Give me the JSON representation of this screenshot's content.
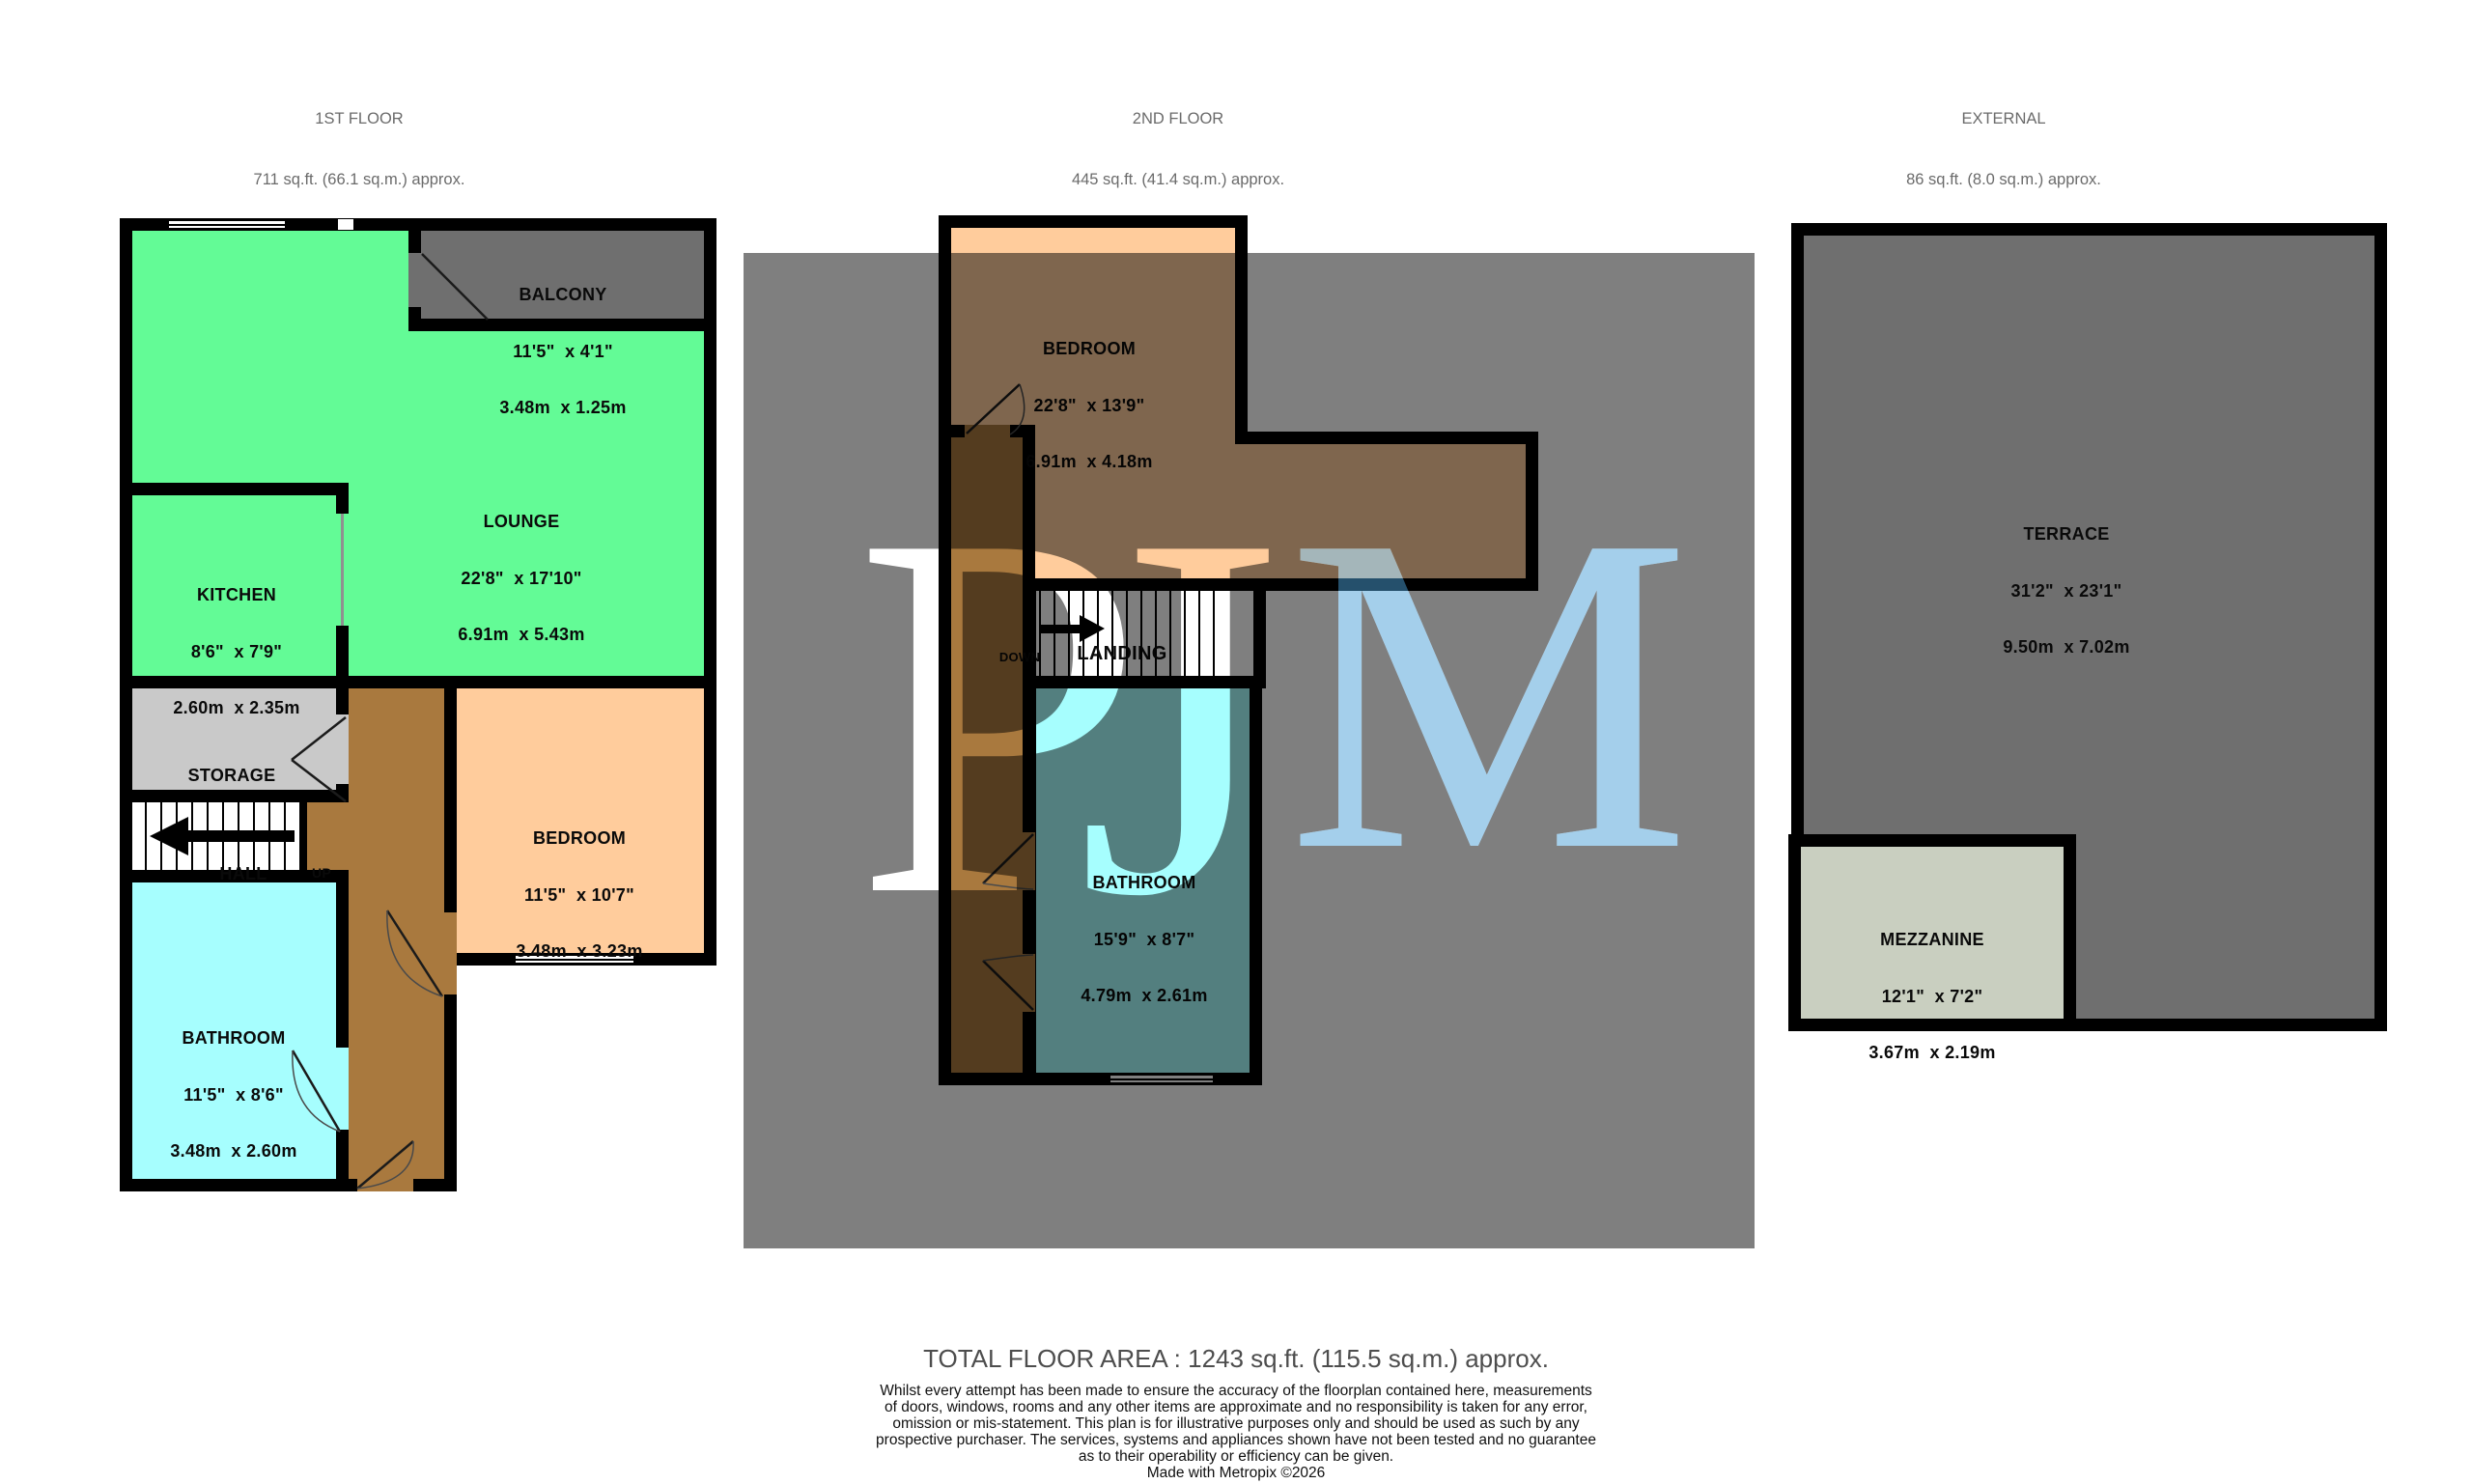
{
  "headers": [
    {
      "title": "1ST FLOOR",
      "area": "711 sq.ft. (66.1 sq.m.) approx."
    },
    {
      "title": "2ND FLOOR",
      "area": "445 sq.ft. (41.4 sq.m.) approx."
    },
    {
      "title": "EXTERNAL",
      "area": "86 sq.ft. (8.0 sq.m.) approx."
    }
  ],
  "rooms": {
    "balcony": {
      "name": "BALCONY",
      "imperial": "11'5\"  x 4'1\"",
      "metric": "3.48m  x 1.25m"
    },
    "lounge": {
      "name": "LOUNGE",
      "imperial": "22'8\"  x 17'10\"",
      "metric": "6.91m  x 5.43m"
    },
    "kitchen": {
      "name": "KITCHEN",
      "imperial": "8'6\"  x 7'9\"",
      "metric": "2.60m  x 2.35m"
    },
    "storage": {
      "name": "STORAGE"
    },
    "hall": {
      "name": "HALL",
      "up": "UP"
    },
    "bedroom1": {
      "name": "BEDROOM",
      "imperial": "11'5\"  x 10'7\"",
      "metric": "3.48m  x 3.23m"
    },
    "bathroom1": {
      "name": "BATHROOM",
      "imperial": "11'5\"  x 8'6\"",
      "metric": "3.48m  x 2.60m"
    },
    "bedroom2": {
      "name": "BEDROOM",
      "imperial": "22'8\"  x 13'9\"",
      "metric": "6.91m  x 4.18m"
    },
    "landing": {
      "name": "LANDING",
      "down": "DOWN"
    },
    "bathroom2": {
      "name": "BATHROOM",
      "imperial": "15'9\"  x 8'7\"",
      "metric": "4.79m  x 2.61m"
    },
    "terrace": {
      "name": "TERRACE",
      "imperial": "31'2\"  x 23'1\"",
      "metric": "9.50m  x 7.02m"
    },
    "mezzanine": {
      "name": "MEZZANINE",
      "imperial": "12'1\"  x 7'2\"",
      "metric": "3.67m  x 2.19m"
    }
  },
  "watermark": {
    "letter_p": "P",
    "letter_j": "J",
    "letter_m": "M"
  },
  "footer": {
    "total": "TOTAL FLOOR AREA : 1243 sq.ft. (115.5 sq.m.) approx.",
    "disclaimer_lines": [
      "Whilst every attempt has been made to ensure the accuracy of the floorplan contained here, measurements",
      "of doors, windows, rooms and any other items are approximate and no responsibility is taken for any error,",
      "omission or mis-statement. This plan is for illustrative purposes only and should be used as such by any",
      "prospective purchaser. The services, systems and appliances shown have not been tested and no guarantee",
      "as to their operability or efficiency can be given."
    ],
    "credit": "Made with Metropix ©2026"
  },
  "colors": {
    "page_bg": "#ffffff",
    "wall": "#000000",
    "green": "#63FB96",
    "peach": "#FFCC9C",
    "cyan": "#A6FEFE",
    "brown": "#A9793E",
    "grey_room": "#C9C9C9",
    "grey_balcony": "#6F6F6F",
    "grey_terrace": "#6F6F6F",
    "sage": "#C9CFC0",
    "m_blue": "#4A9FD8",
    "header_text": "#6b6b6b",
    "total_text": "#4d4d4d"
  }
}
